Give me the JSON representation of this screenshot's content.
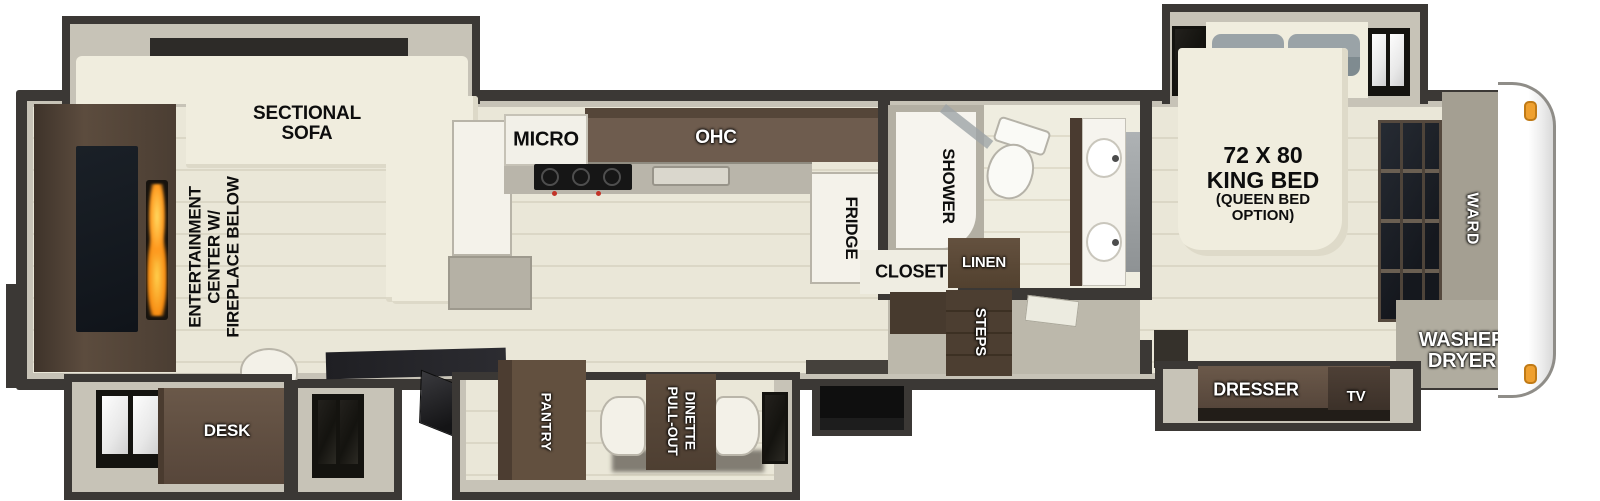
{
  "floorplan": {
    "rear_living": {
      "sofa": "SECTIONAL\nSOFA",
      "entertainment": "ENTERTAINMENT\nCENTER W/\nFIREPLACE BELOW",
      "desk": "DESK"
    },
    "kitchen": {
      "micro": "MICRO",
      "ohc": "OHC",
      "fridge": "FRIDGE",
      "pantry": "PANTRY",
      "dinette": "PULL-OUT\nDINETTE"
    },
    "bath": {
      "shower": "SHOWER",
      "closet": "CLOSET",
      "linen": "LINEN",
      "steps": "STEPS"
    },
    "bedroom": {
      "bed_size": "72 X 80\nKING BED",
      "bed_option": "(QUEEN BED\nOPTION)",
      "ward": "WARD",
      "washer_dryer": "WASHER\nDRYER",
      "dresser": "DRESSER",
      "tv": "TV"
    },
    "colors": {
      "wall": "#3b3835",
      "wall_face": "#c7c3b7",
      "floor_plank": "#eae7d8",
      "cabinet_brown": "#5e4c3e",
      "cabinet_dark_brown": "#473a2e",
      "upholstery_cream": "#f0edde",
      "pillow_gray": "#97a0a4",
      "tv_glass": "#1d2127",
      "flame_orange": "#ff9d2e",
      "marker_light": "#efa02f",
      "label_black": "#0d0d0d",
      "label_white": "#ffffff"
    }
  }
}
